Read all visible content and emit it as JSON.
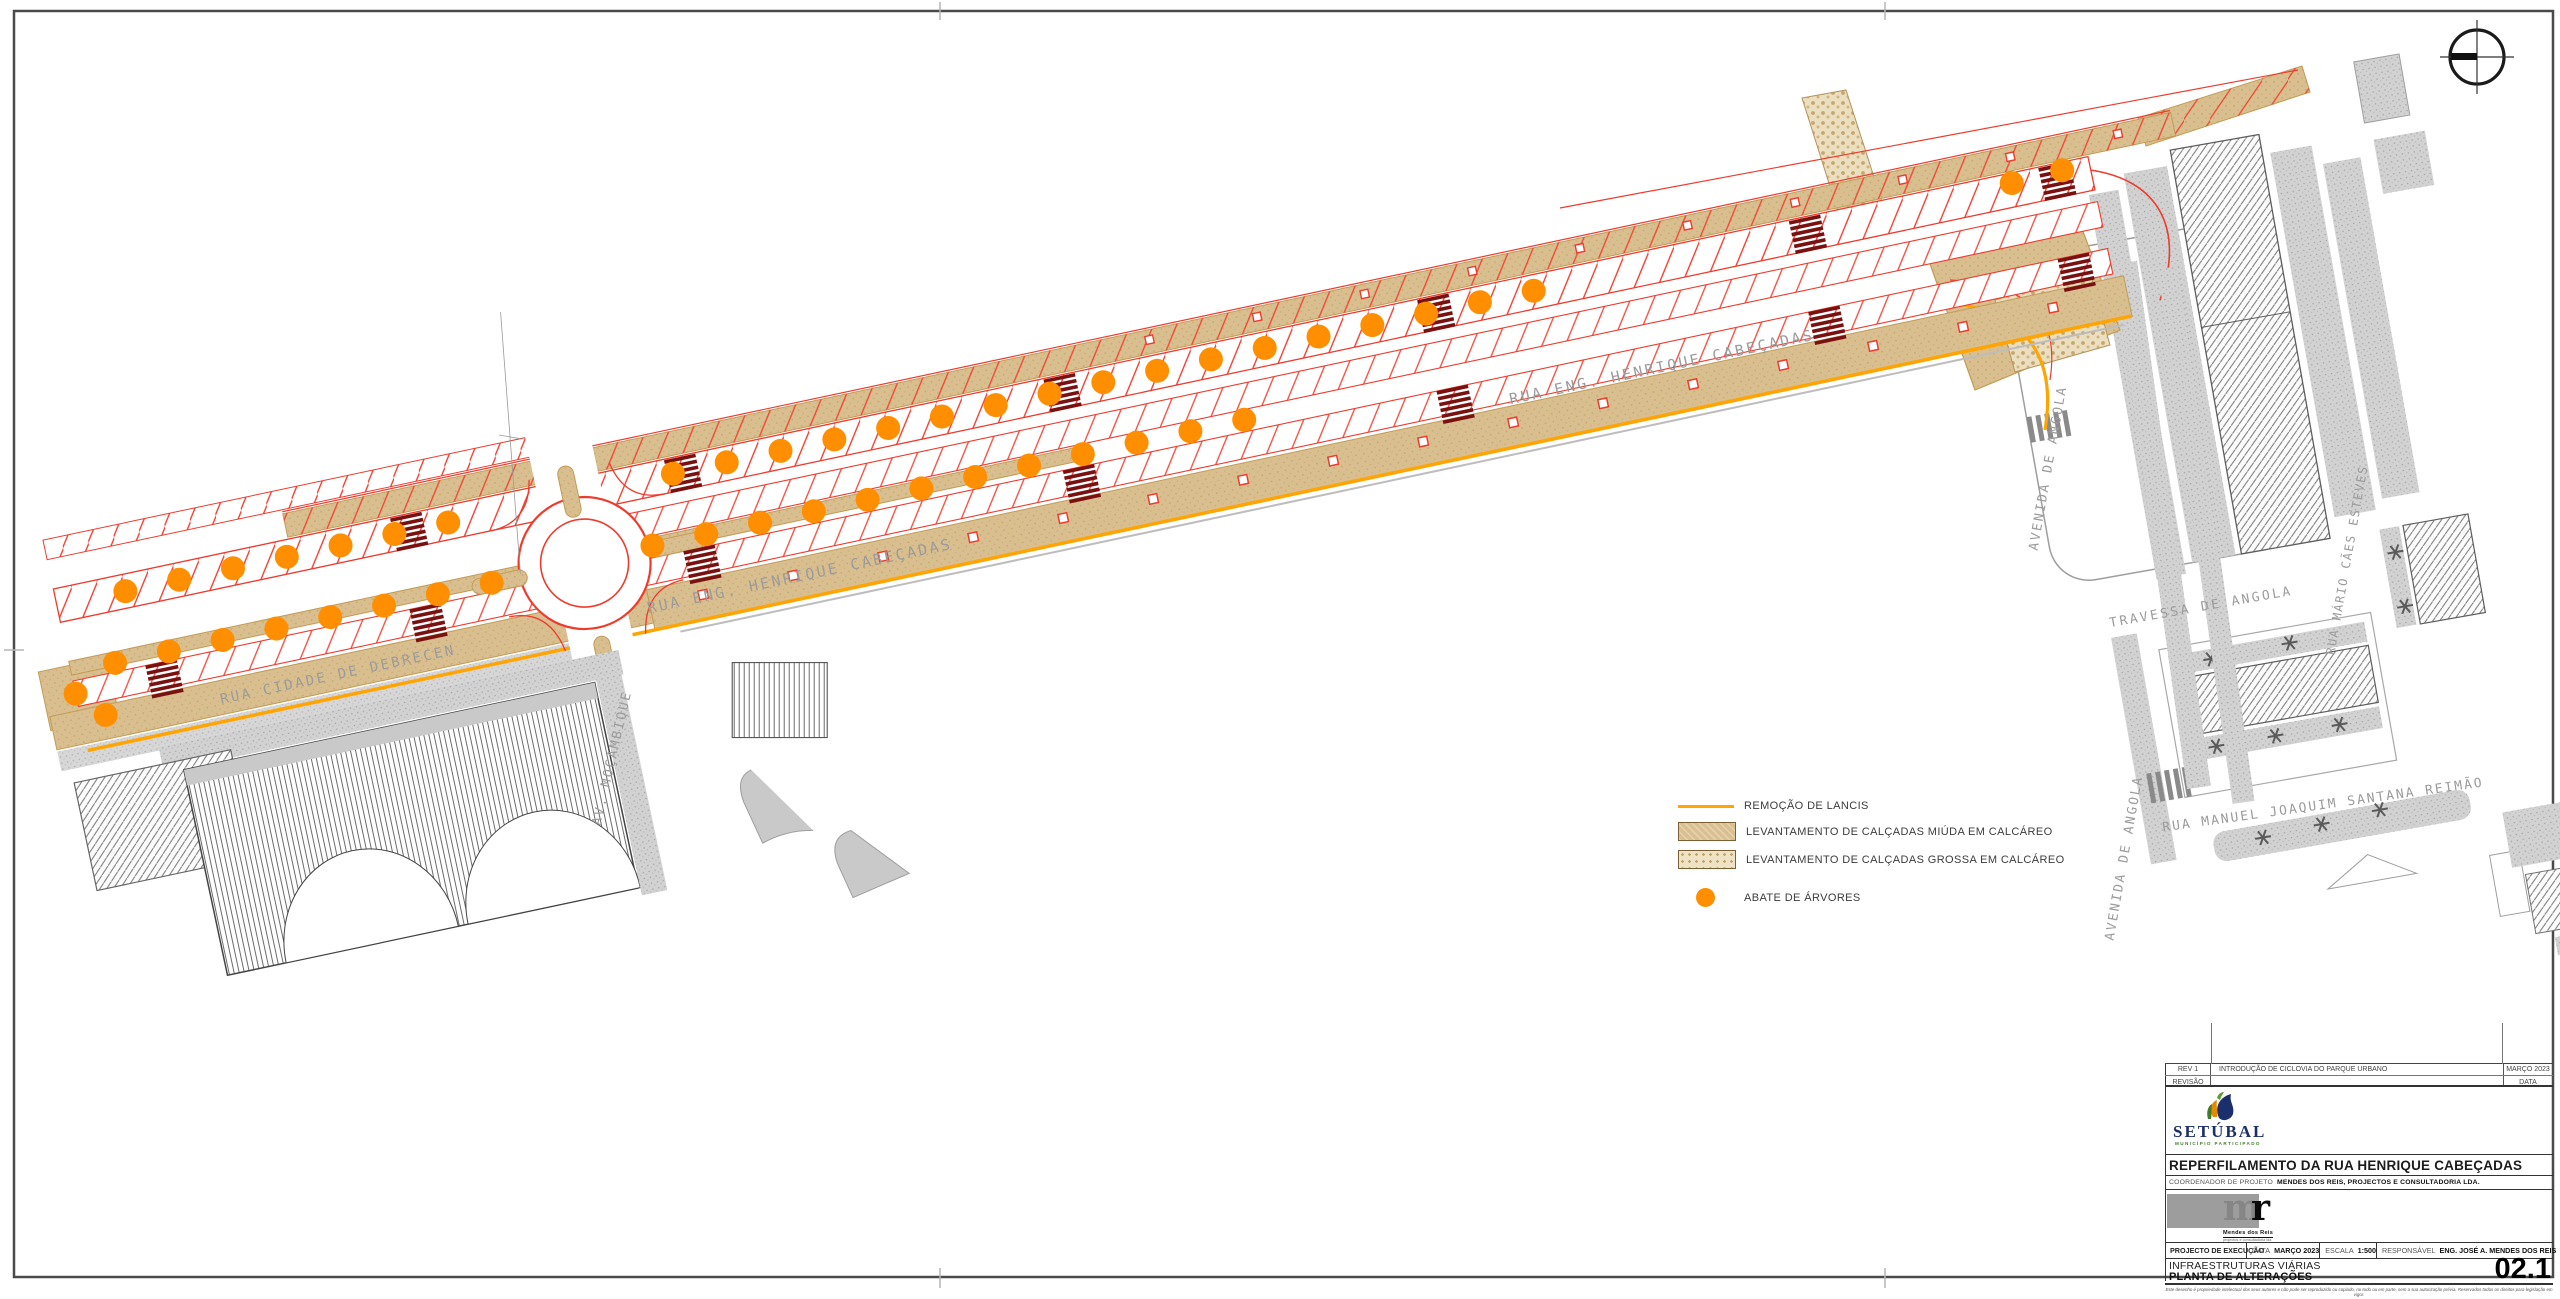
{
  "sheet": {
    "project_title": "REPERFILAMENTO DA RUA HENRIQUE CABEÇADAS",
    "discipline": "INFRAESTRUTURAS VIÁRIAS",
    "drawing_title": "PLANTA DE ALTERAÇÕES",
    "sheet_number": "02.1",
    "phase_label": "PROJECTO DE EXECUÇÃO",
    "date_label": "DATA",
    "date_value": "MARÇO 2023",
    "scale_label": "ESCALA",
    "scale_value": "1:500",
    "responsible_label": "RESPONSÁVEL",
    "responsible_value": "ENG. JOSÉ A. MENDES DOS REIS",
    "coordinator_label": "COORDENADOR DE PROJETO",
    "coordinator_value": "MENDES DOS REIS, PROJECTOS E CONSULTADORIA LDA.",
    "copyright": "Este desenho é propriedade intelectual dos seus autores e não pode ser reproduzido ou copiado, no todo ou em parte, sem a sua autorização prévia. Reservados todos os direitos para legislação em vigor."
  },
  "revisions": {
    "header": {
      "rev": "REVISÃO",
      "date": "DATA"
    },
    "rows": [
      {
        "rev": "REV 1",
        "desc": "INTRODUÇÃO DE CICLOVIA DO PARQUE URBANO",
        "date": "MARÇO 2023"
      }
    ]
  },
  "logos": {
    "municipality_name": "SETÚBAL",
    "municipality_tagline": "MUNICÍPIO PARTICIPADO",
    "company_m": "m",
    "company_r": "r",
    "company_name": "Mendes dos Reis",
    "company_subtitle": "projectos e consultadoria lda"
  },
  "legend": {
    "items": [
      {
        "label": "REMOÇÃO DE LANCIS",
        "swatch": "orange-line"
      },
      {
        "label": "LEVANTAMENTO DE CALÇADAS MIÚDA EM CALCÁREO",
        "swatch": "tan-solid"
      },
      {
        "label": "LEVANTAMENTO DE CALÇADAS GROSSA EM CALCÁREO",
        "swatch": "tan-dotted"
      },
      {
        "label": "ABATE DE ÁRVORES",
        "swatch": "orange-circle"
      }
    ]
  },
  "streets": {
    "main1": "RUA ENG. HENRIQUE CABEÇADAS",
    "main2": "RUA ENG. HENRIQUE CABEÇADAS",
    "debrecen": "RUA CIDADE DE DEBRECEN",
    "mozambique": "AV. MOÇAMBIQUE",
    "angola_avenue_north": "AVENIDA DE ANGOLA",
    "angola_avenue_south": "AVENIDA DE ANGOLA",
    "angola_travessa": "TRAVESSA DE ANGOLA",
    "mario_esteves": "RUA MÁRIO CÃES ESTEVES",
    "santana_reimao": "RUA MANUEL JOAQUIM SANTANA REIMÃO"
  },
  "colors": {
    "tree_orange": "#FF8F00",
    "curb_orange": "#FFA400",
    "project_red": "#EF3B2D",
    "crosswalk_dark_red": "#7A1111",
    "sidewalk_tan": "#D9BF8F",
    "existing_gray": "#C9C9C9",
    "logo_blue": "#1A2F6B",
    "logo_green": "#3F7D2C"
  }
}
